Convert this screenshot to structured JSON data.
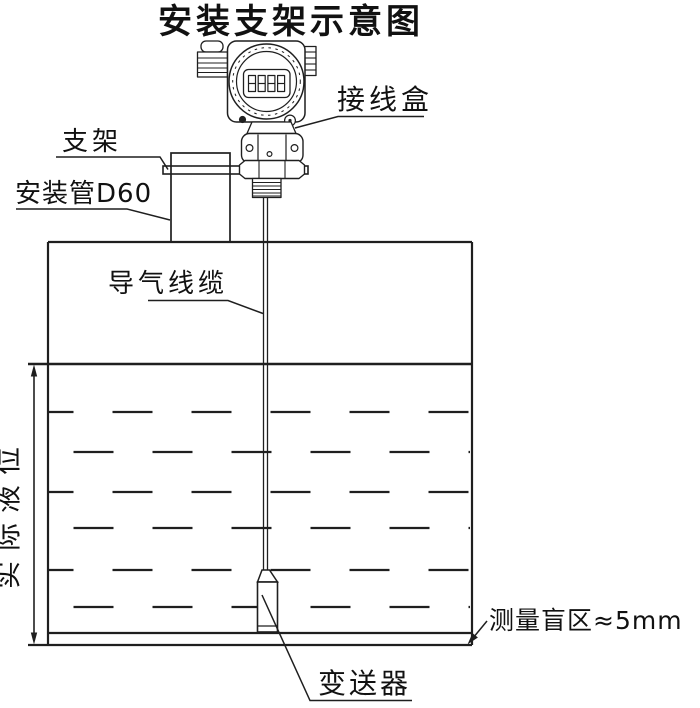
{
  "title": "安装支架示意图",
  "labels": {
    "junction_box": "接线盒",
    "bracket": "支架",
    "mounting_pipe": "安装管D60",
    "air_cable": "导气线缆",
    "actual_level": "实际液位",
    "blind_zone": "测量盲区≈5mm",
    "transmitter": "变送器"
  },
  "lcd": {
    "value": "8888"
  },
  "colors": {
    "line": "#1f1f1f",
    "text": "#111111",
    "background": "#ffffff"
  }
}
